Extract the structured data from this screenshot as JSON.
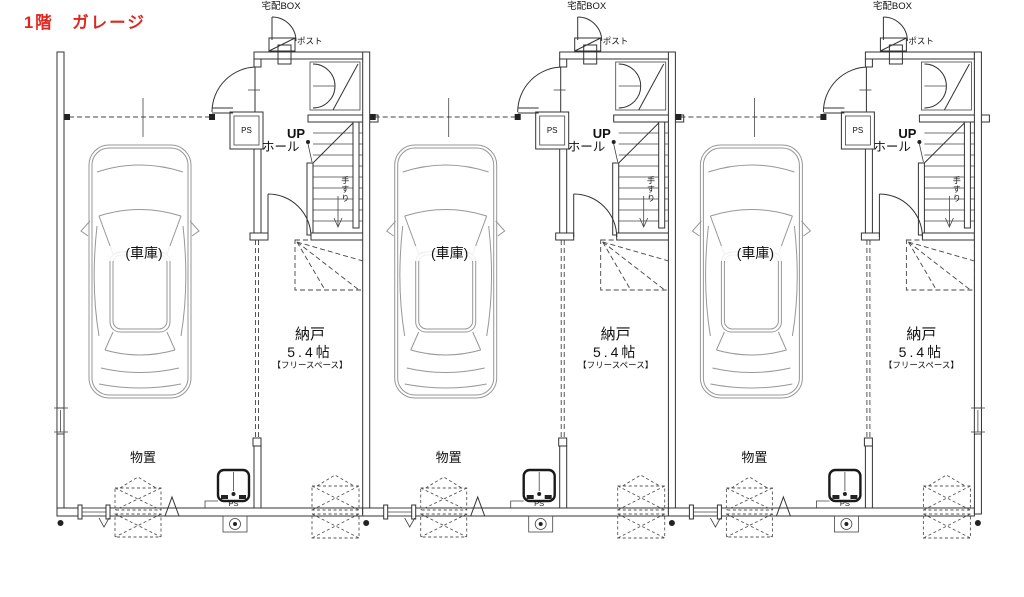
{
  "title": {
    "text": "1階　ガレージ",
    "color": "#e0261e"
  },
  "unit_count": 3,
  "unit_labels": {
    "delivery_box": "宅配BOX",
    "mailbox": "ポスト",
    "pipe_space_top": "PS",
    "up": "UP",
    "hall": "ホール",
    "handrail": "手すり",
    "storage_room": "納戸",
    "storage_room_size": "5.4帖",
    "storage_room_note": "【フリースペース】",
    "garage": "(車庫)",
    "storage_area": "物置",
    "pipe_space_bottom": "PS"
  }
}
